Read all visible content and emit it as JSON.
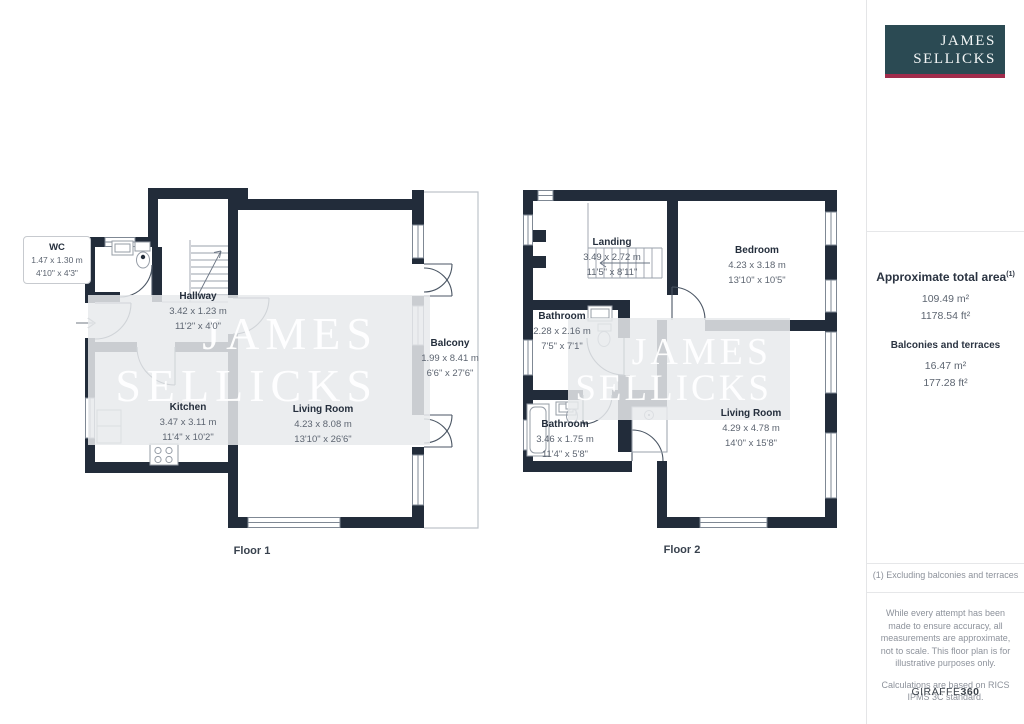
{
  "brand": {
    "line1": "JAMES",
    "line2": "SELLICKS"
  },
  "colors": {
    "wall": "#222c3a",
    "watermark": "#e8eaec",
    "logo_teal": "#2b4a53",
    "logo_crimson": "#a12c4c"
  },
  "floors": [
    {
      "caption": "Floor 1",
      "rooms": [
        {
          "name": "WC",
          "metric": "1.47 x 1.30 m",
          "imperial": "4'10\" x 4'3\""
        },
        {
          "name": "Hallway",
          "metric": "3.42 x 1.23 m",
          "imperial": "11'2\" x 4'0\""
        },
        {
          "name": "Kitchen",
          "metric": "3.47 x 3.11 m",
          "imperial": "11'4\" x 10'2\""
        },
        {
          "name": "Living Room",
          "metric": "4.23 x 8.08 m",
          "imperial": "13'10\" x 26'6\""
        },
        {
          "name": "Balcony",
          "metric": "1.99 x 8.41 m",
          "imperial": "6'6\" x 27'6\""
        }
      ]
    },
    {
      "caption": "Floor 2",
      "rooms": [
        {
          "name": "Landing",
          "metric": "3.49 x 2.72 m",
          "imperial": "11'5\" x 8'11\""
        },
        {
          "name": "Bedroom",
          "metric": "4.23 x 3.18 m",
          "imperial": "13'10\" x 10'5\""
        },
        {
          "name": "Bathroom",
          "metric": "2.28 x 2.16 m",
          "imperial": "7'5\" x 7'1\""
        },
        {
          "name": "Bathroom",
          "metric": "3.46 x 1.75 m",
          "imperial": "11'4\" x 5'8\""
        },
        {
          "name": "Living Room",
          "metric": "4.29 x 4.78 m",
          "imperial": "14'0\" x 15'8\""
        }
      ]
    }
  ],
  "sidebar": {
    "total_area_label": "Approximate total area",
    "total_area_sup": "(1)",
    "total_area_m2": "109.49 m²",
    "total_area_ft2": "1178.54 ft²",
    "balconies_label": "Balconies and terraces",
    "balconies_m2": "16.47 m²",
    "balconies_ft2": "177.28 ft²",
    "footnote": "(1) Excluding balconies and terraces",
    "disclaimer": "While every attempt has been made to ensure accuracy, all measurements are approximate, not to scale. This floor plan is for illustrative purposes only.",
    "calculations": "Calculations are based on RICS IPMS 3C standard.",
    "brand_name": "GIRAFFE",
    "brand_suffix": "360"
  }
}
